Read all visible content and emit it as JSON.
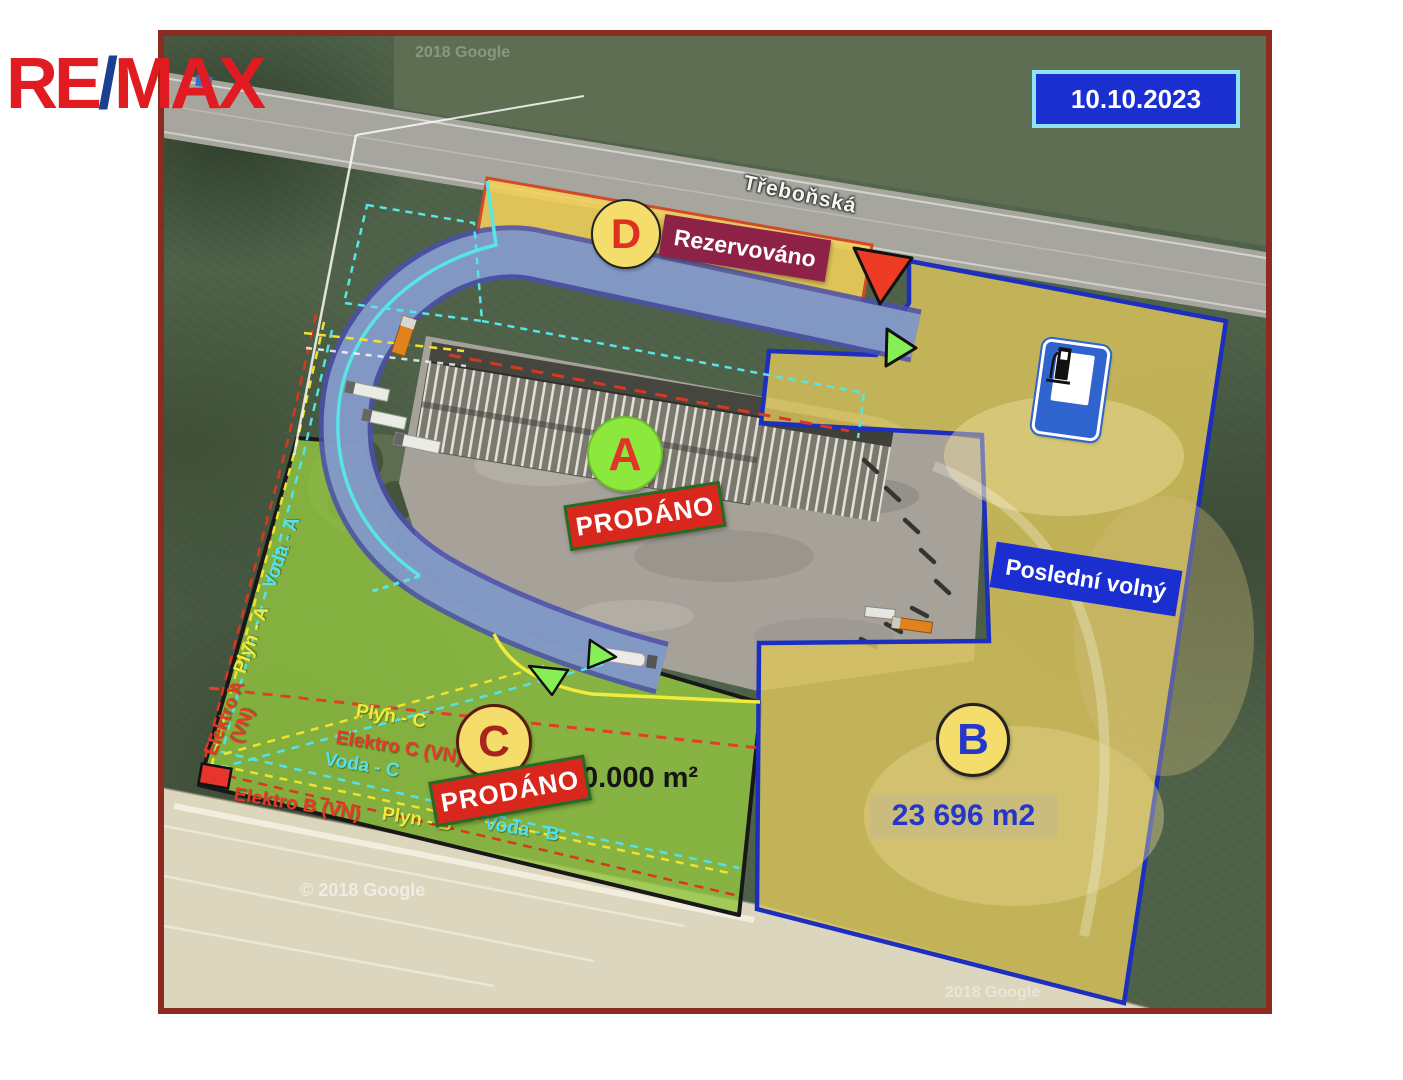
{
  "logo": {
    "re": "RE",
    "slash": "/",
    "max": "MAX"
  },
  "date_badge": {
    "text": "10.10.2023"
  },
  "map": {
    "street_label": "Třeboňská",
    "watermark_top": "2018 Google",
    "watermark_bottom_left": "© 2018 Google",
    "watermark_bottom_right": "2018 Google"
  },
  "plots": {
    "a": {
      "letter": "A",
      "status": "PRODÁNO"
    },
    "b": {
      "letter": "B",
      "area": "23 696 m2",
      "availability": "Poslední volný"
    },
    "c": {
      "letter": "C",
      "status": "PRODÁNO",
      "area_visible": "0.000 m²"
    },
    "d": {
      "letter": "D",
      "status": "Rezervováno"
    }
  },
  "utilities": {
    "voda_a": "Voda - A",
    "plyn_a": "Plyn - A",
    "elektro_a_line1": "Elektro A",
    "elektro_a_line2": "(VN)",
    "plyn_c": "Plyn - C",
    "elektro_c": "Elektro C (VN)",
    "voda_c": "Voda - C",
    "elektro_b": "Elektro B (VN)",
    "plyn_b": "Plyn - B",
    "voda_b": "Voda - B"
  },
  "colors": {
    "frame_red": "#8c2b21",
    "accent_blue": "#1b2fd0",
    "sold_red": "#d8281e",
    "reserved_magenta": "#8e2148",
    "plot_circle_yellow": "#f4dd6a",
    "plot_a_green": "#8ce83c",
    "plot_b_border_blue": "#1c2fbf",
    "water_cyan": "#52e2ec",
    "gas_yellow": "#f2ea3c",
    "electric_red": "#e8382a"
  },
  "icons": {
    "fuel_station": "fuel-pump-sign",
    "red_marker": "red-triangle-marker",
    "green_marker": "green-triangle-marker"
  }
}
